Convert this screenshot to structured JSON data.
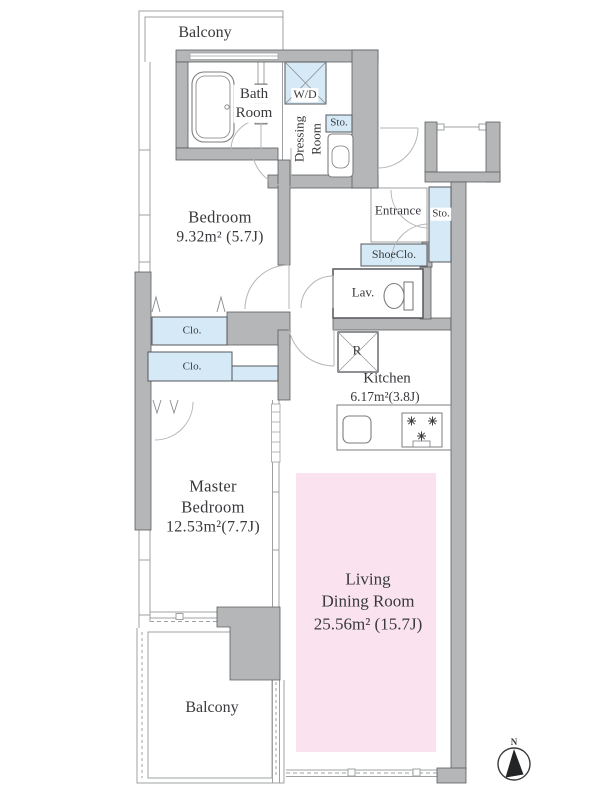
{
  "plan": {
    "balcony_top": "Balcony",
    "balcony_bottom": "Balcony",
    "bath": {
      "line1": "Bath",
      "line2": "Room"
    },
    "washer_dryer": "W/D",
    "dressing": {
      "line1": "Dressing",
      "line2": "Room"
    },
    "storage_top": "Sto.",
    "storage_right": "Sto.",
    "bedroom": {
      "name": "Bedroom",
      "area": "9.32m² (5.7J)"
    },
    "entrance": "Entrance",
    "shoe_closet": "ShoeClo.",
    "lavatory": "Lav.",
    "closet_upper": "Clo.",
    "closet_lower": "Clo.",
    "refrigerator": "R",
    "kitchen": {
      "name": "Kitchen",
      "area": "6.17m²(3.8J)"
    },
    "master_bedroom": {
      "line1": "Master",
      "line2": "Bedroom",
      "area": "12.53m²(7.7J)"
    },
    "living_dining": {
      "line1": "Living",
      "line2": "Dining Room",
      "area": "25.56m² (15.7J)"
    },
    "compass_north": "N"
  },
  "colors": {
    "wall": "#b4b6b8",
    "wall_edge": "#5b5c5e",
    "storage_fill": "#d5eaf6",
    "living_fill": "#fae3ee",
    "thin_line": "#9fa0a2",
    "fixture_line": "#7c7d7f",
    "text": "#38393c"
  }
}
